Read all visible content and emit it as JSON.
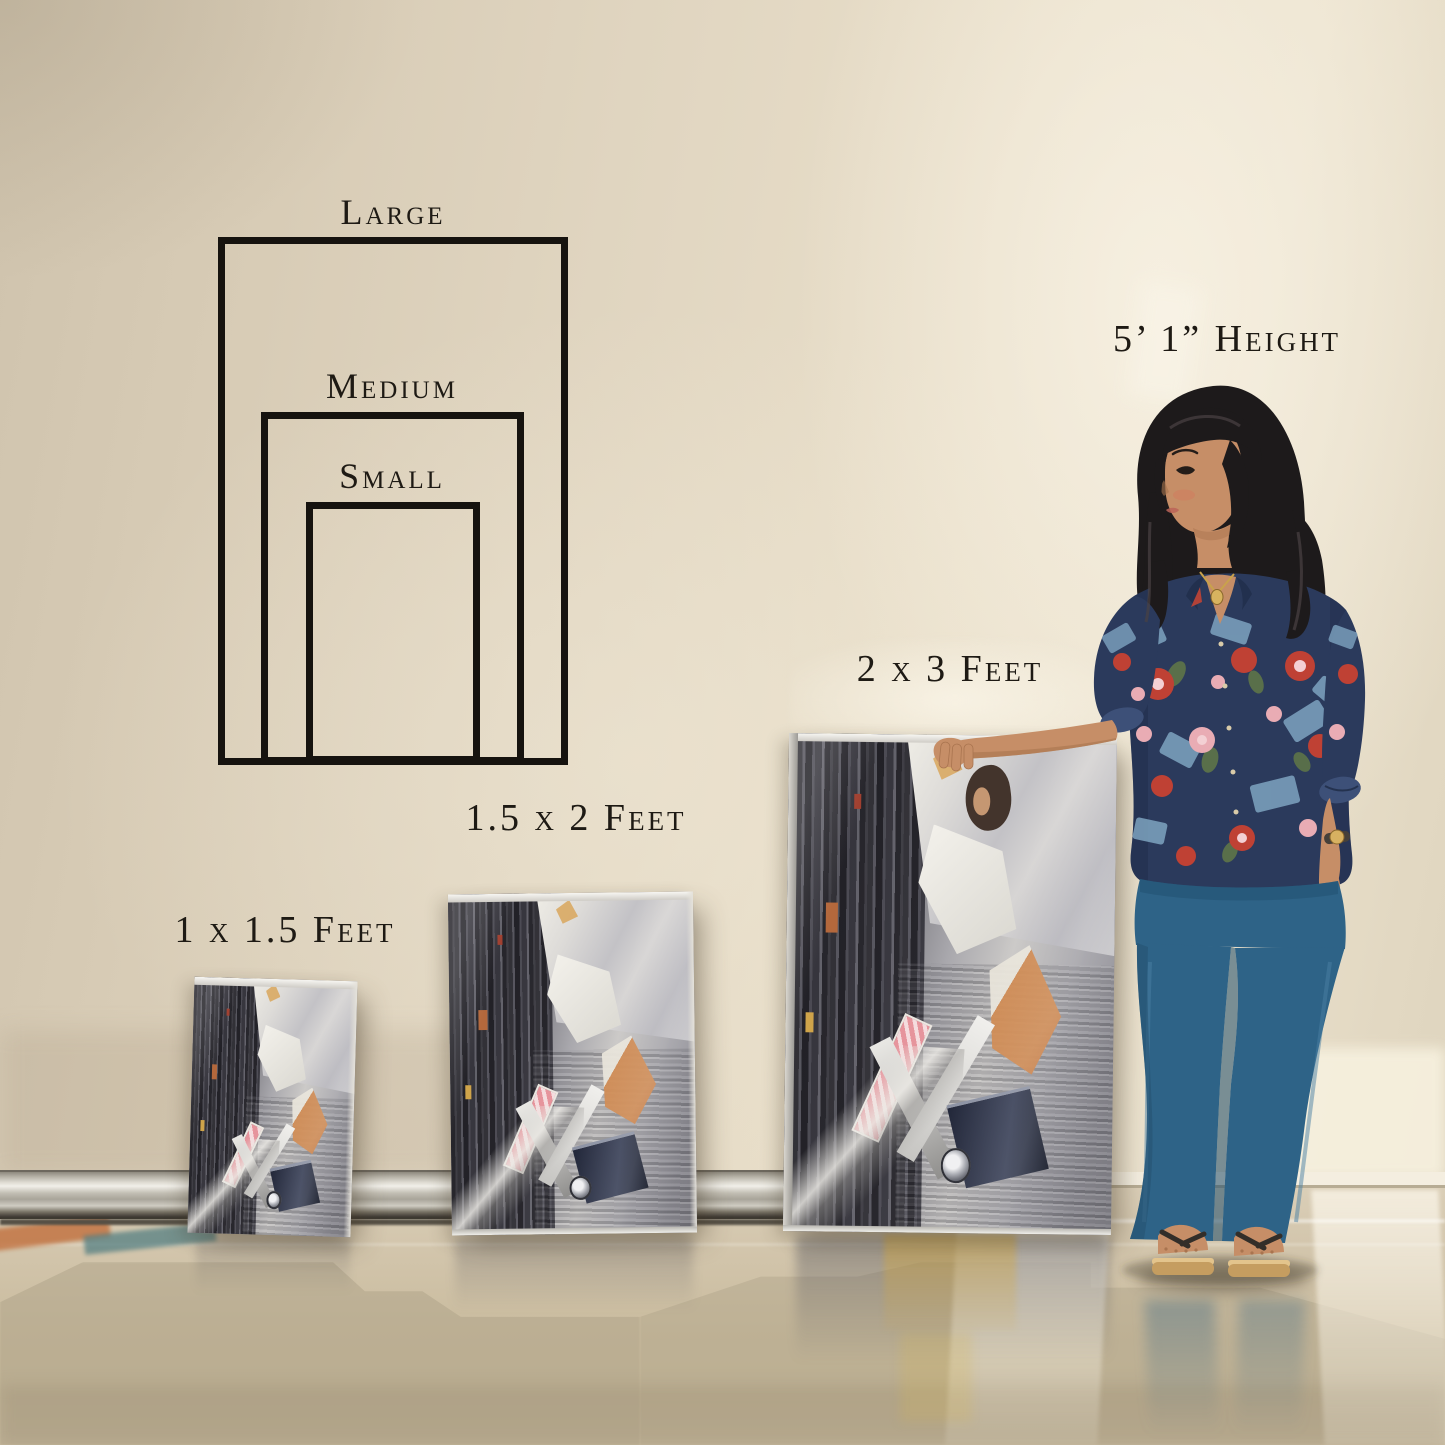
{
  "size_diagram": {
    "sizes": [
      {
        "name": "large",
        "label": "Large"
      },
      {
        "name": "medium",
        "label": "Medium"
      },
      {
        "name": "small",
        "label": "Small"
      }
    ]
  },
  "figure": {
    "height_label": "5’ 1” Height"
  },
  "canvases": [
    {
      "name": "small",
      "label": "1 x 1.5 Feet"
    },
    {
      "name": "medium",
      "label": "1.5 x 2 Feet"
    },
    {
      "name": "large",
      "label": "2 x 3 Feet"
    }
  ],
  "palette": {
    "text": "#1e1a14",
    "diagram_line": "#16130f",
    "wall_beige": "#e0d5c0",
    "floor_tan": "#cabc9f",
    "baseboard_silver": "#cfccc2",
    "denim_blue": "#2e6387",
    "blouse_navy": "#2b3a5c",
    "flower_red": "#bf4134",
    "flower_pink": "#e9acb4",
    "skin_tan": "#c68e67",
    "hair_black": "#1d1a1b",
    "canvas_gray": "#8e8d93",
    "accent_orange": "#cf8a52"
  }
}
